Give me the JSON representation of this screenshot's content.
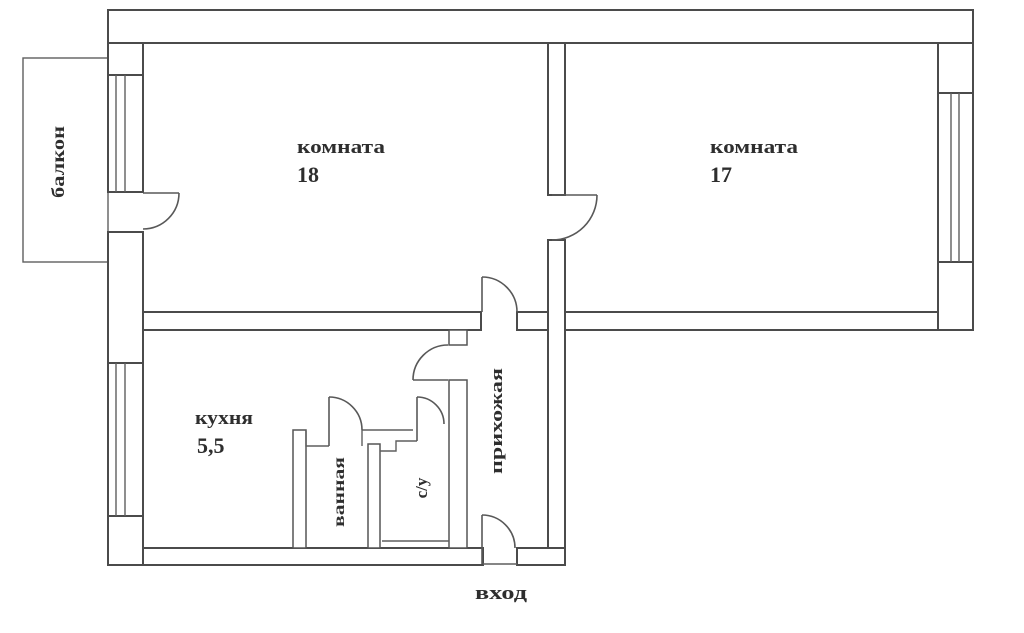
{
  "plan": {
    "type": "apartment-floor-plan",
    "rooms": {
      "room18": {
        "name": "комната",
        "area": "18"
      },
      "room17": {
        "name": "комната",
        "area": "17"
      },
      "kitchen": {
        "name": "кухня",
        "area": "5,5"
      },
      "bathroom": {
        "name": "ванная"
      },
      "wc": {
        "name": "с/у"
      },
      "hallway": {
        "name": "прихожая"
      },
      "balcony": {
        "name": "балкон"
      }
    },
    "entrance": {
      "name": "вход"
    },
    "colors": {
      "background": "#ffffff",
      "wall_line": "#4b4b4b",
      "thin_line": "#5f5f5f",
      "text": "#2e2e2e"
    }
  }
}
